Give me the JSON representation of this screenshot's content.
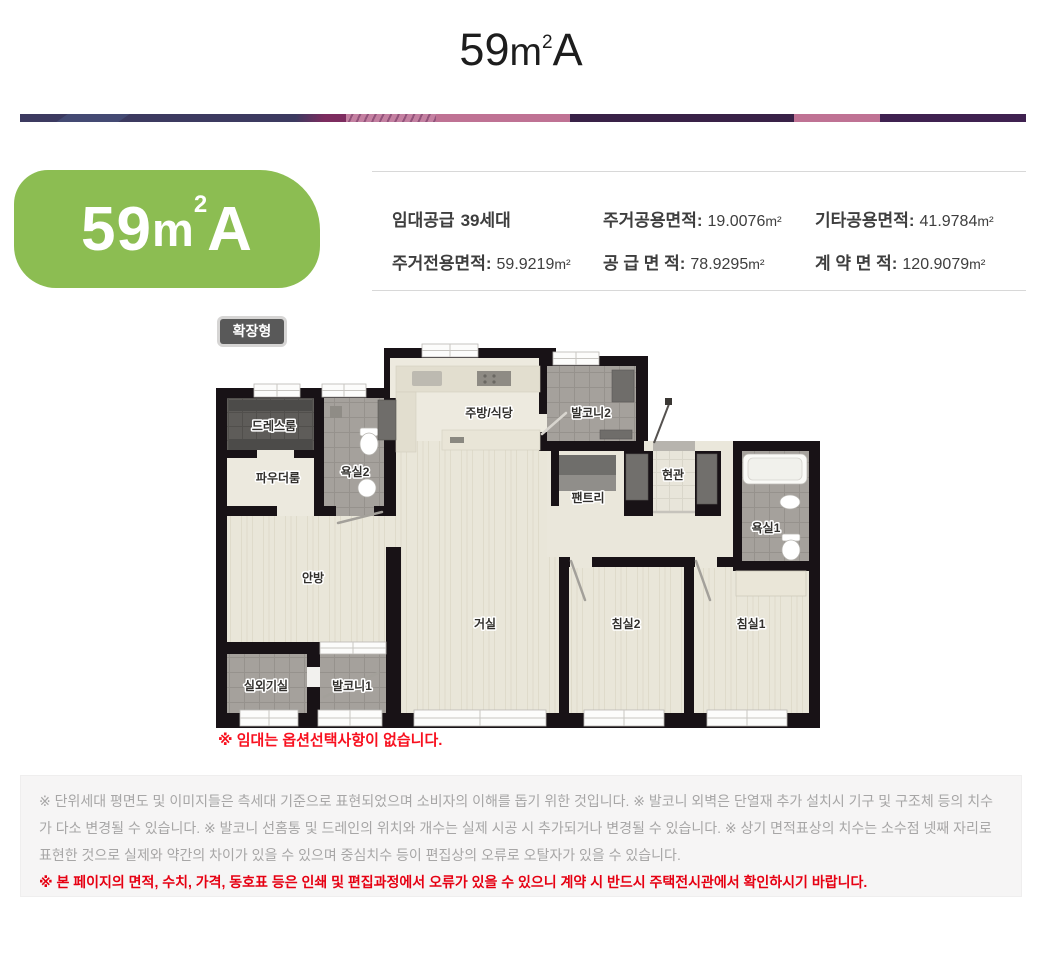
{
  "title": {
    "num": "59",
    "m": "m",
    "sup": "2",
    "letter": "A"
  },
  "unit_badge": {
    "num": "59",
    "m": "m",
    "sup": "2",
    "letter": "A",
    "bg_color": "#8cbd52"
  },
  "info": {
    "lease": {
      "prefix": "임대공급",
      "count": "39",
      "suffix": "세대"
    },
    "items": [
      {
        "label": "주거전용면적:",
        "value": "59.9219",
        "unit": "m²"
      },
      {
        "label": "주거공용면적:",
        "value": "19.0076",
        "unit": "m²"
      },
      {
        "label": "공 급 면 적:",
        "value": "78.9295",
        "unit": "m²"
      },
      {
        "label": "기타공용면적:",
        "value": "41.9784",
        "unit": "m²"
      },
      {
        "label": "계 약 면 적:",
        "value": "120.9079",
        "unit": "m²"
      }
    ]
  },
  "plan": {
    "type_badge": "확장형",
    "note": "※ 임대는 옵션선택사항이 없습니다.",
    "rooms": {
      "dress": "드레스룸",
      "powder": "파우더룸",
      "bath2": "욕실2",
      "kitchen": "주방/식당",
      "balcony2": "발코니2",
      "entrance": "현관",
      "pantry": "팬트리",
      "bath1": "욕실1",
      "master": "안방",
      "living": "거실",
      "bed2": "침실2",
      "bed1": "침실1",
      "outdoor": "실외기실",
      "balcony1": "발코니1"
    }
  },
  "footer": {
    "disclaimer": "※ 단위세대 평면도 및 이미지들은 측세대 기준으로 표현되었으며 소비자의 이해를 돕기 위한 것입니다. ※ 발코니 외벽은 단열재 추가 설치시 기구 및 구조체 등의 치수가 다소 변경될 수 있습니다. ※ 발코니 선홈통 및 드레인의 위치와 개수는 실제 시공 시 추가되거나 변경될 수 있습니다. ※ 상기 면적표상의 치수는 소수점 넷째 자리로 표현한 것으로 실제와 약간의 차이가 있을 수 있으며 중심치수 등이 편집상의 오류로 오탈자가 있을 수 있습니다.",
    "warning": "※ 본 페이지의 면적, 수치, 가격, 동호표 등은 인쇄 및 편집과정에서 오류가 있을 수 있으니 계약 시 반드시 주택전시관에서 확인하시기 바랍니다."
  },
  "colors": {
    "accent_green": "#8cbd52",
    "lease_green": "#8bbd4e",
    "note_red": "#f8101f",
    "warning_red": "#e60012",
    "wall_black": "#181216",
    "floor_wood": "#e9e6d9",
    "tile_gray": "#a5a19c",
    "tile_dark": "#5e5c59",
    "bar_colors": [
      "#3c3a60",
      "#7d2c5f",
      "#c480a1",
      "#bf7294",
      "#392147",
      "#3f2150"
    ]
  }
}
